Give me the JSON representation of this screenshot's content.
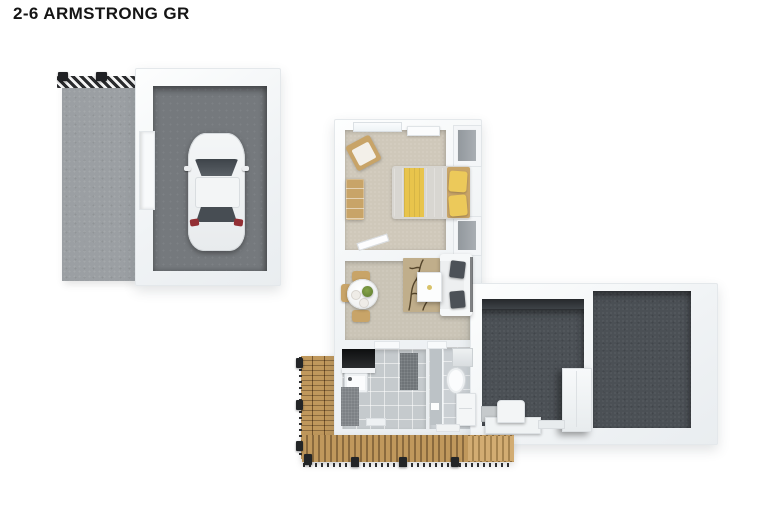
{
  "title": "2-6 ARMSTRONG GR",
  "colors": {
    "wall_edge": "#e4e8eb",
    "driveway": "#9b9fa3",
    "garage_floor": "#75797d",
    "carpet": "#cfc8ba",
    "carpet_living": "#cac4b6",
    "tile": "#c5cacd",
    "tile_bath": "#cbd0d4",
    "dark_floor": "#4b5055",
    "deck": "#c0985c",
    "deck_gap": "#8a6a3e",
    "deck_light": "#d2ac72",
    "yellow": "#e8c44c",
    "wood": "#c8a468",
    "rug": "#c0ae8b",
    "cushion": "#4c5157",
    "hatch": "#2a2b2d",
    "taillight": "#932f34",
    "plant": "#5d7a30"
  },
  "objects": [
    "driveway",
    "fence-hatch",
    "garage",
    "car",
    "bedroom",
    "window",
    "wardrobe",
    "bed",
    "pillows",
    "dresser",
    "chair",
    "living-dining",
    "dining-table",
    "dining-chairs",
    "rug",
    "coffee-table",
    "sofa",
    "laundry",
    "laundry-counter",
    "laundry-tub",
    "bathroom",
    "shower",
    "toilet",
    "vanity",
    "patio-left",
    "patio-right",
    "hot-water-cabinet",
    "bench",
    "deck"
  ]
}
